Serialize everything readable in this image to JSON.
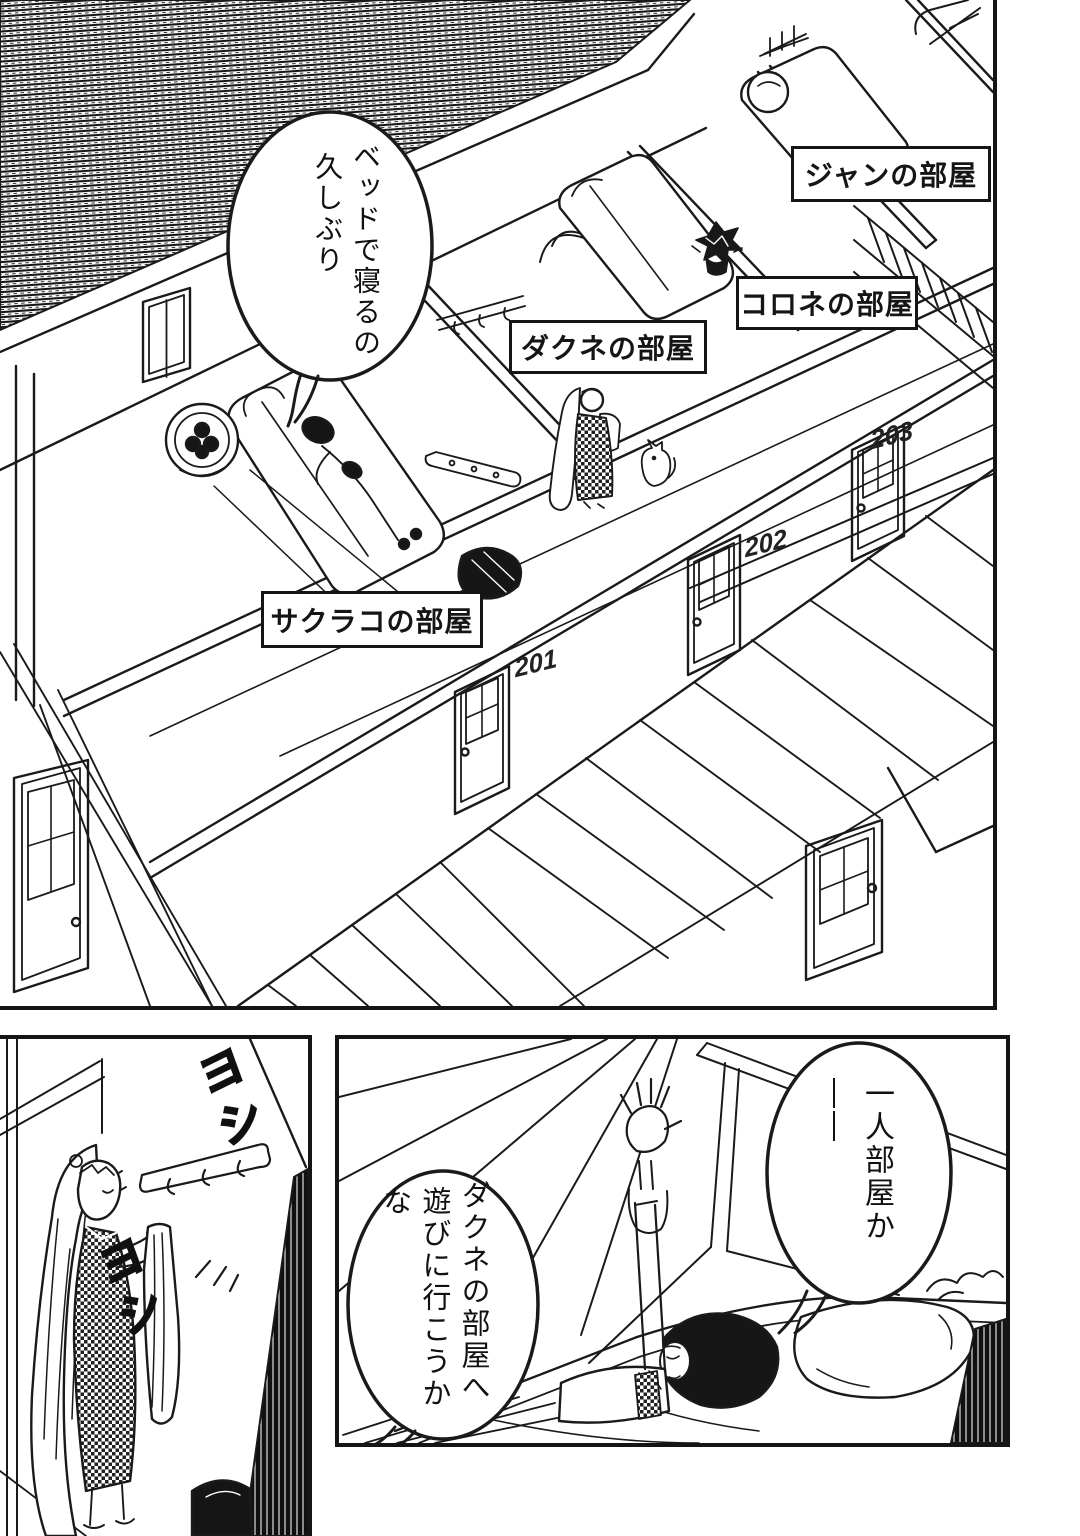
{
  "colors": {
    "ink": "#151515",
    "paper": "#ffffff"
  },
  "top_panel": {
    "speech_bubble": {
      "line1": "ベッドで寝るの",
      "line2": "久しぶり"
    },
    "room_labels": {
      "jan": "ジャンの部屋",
      "korone": "コロネの部屋",
      "dakune": "ダクネの部屋",
      "sakurako": "サクラコの部屋"
    },
    "door_numbers": {
      "d201": "201",
      "d202": "202",
      "d203": "203"
    }
  },
  "bottom_left_panel": {
    "sfx_top": "ヨシ",
    "sfx_bottom": "ヨシ"
  },
  "bottom_right_panel": {
    "bubble_right": "一人部屋か――",
    "bubble_left": {
      "line1": "ダクネの部屋へ",
      "line2": "遊びに行こうかな"
    }
  }
}
